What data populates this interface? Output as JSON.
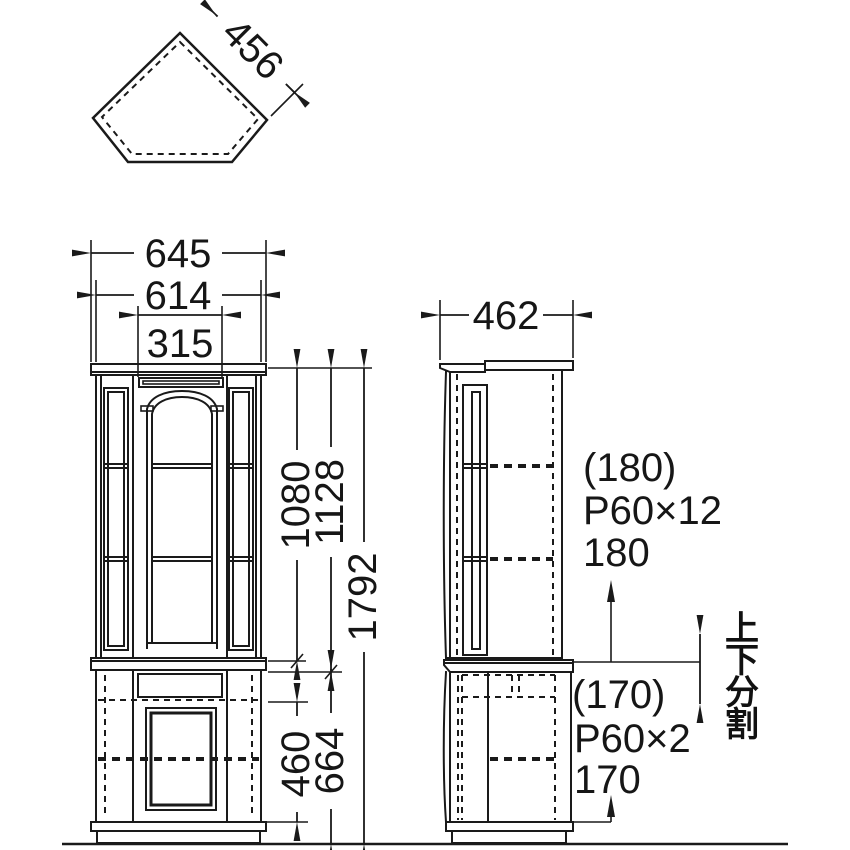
{
  "colors": {
    "line": "#1a1a1a",
    "background": "#ffffff"
  },
  "top_view": {
    "depth_dim": "456"
  },
  "front_view": {
    "width_overall": "645",
    "width_body": "614",
    "width_center": "315",
    "height_upper_opening": "1080",
    "height_upper_unit": "1128",
    "height_overall": "1792",
    "height_lower_opening": "460",
    "height_lower_unit": "664"
  },
  "side_view": {
    "depth_dim": "462"
  },
  "notes": {
    "upper": {
      "gap_top": "(180)",
      "pitch": "P60×12",
      "gap_bottom": "180"
    },
    "lower": {
      "gap_top": "(170)",
      "pitch": "P60×2",
      "gap_bottom": "170"
    },
    "split": {
      "label": "上下分割",
      "chars": [
        "上",
        "下",
        "分",
        "割"
      ]
    }
  }
}
